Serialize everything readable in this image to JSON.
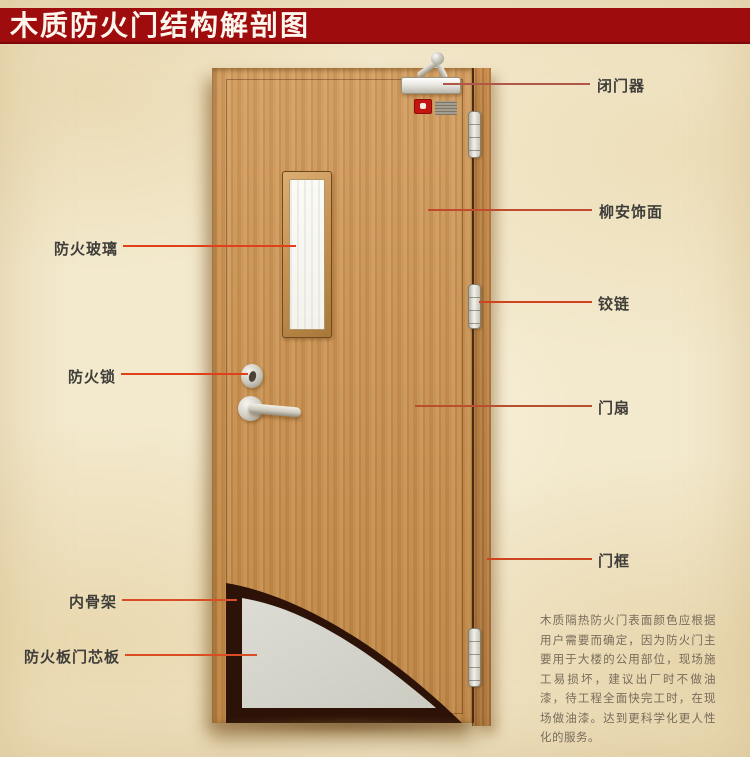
{
  "title": "木质防火门结构解剖图",
  "labels": {
    "door_closer": "闭门器",
    "veneer": "柳安饰面",
    "hinge": "铰链",
    "door_leaf": "门扇",
    "door_frame": "门框",
    "fire_glass": "防火玻璃",
    "fire_lock": "防火锁",
    "inner_skeleton": "内骨架",
    "core_board": "防火板门芯板"
  },
  "note": "木质隔热防火门表面颜色应根据用户需要而确定，因为防火门主要用于大楼的公用部位，现场施工易损坏，建议出厂时不做油漆，待工程全面快完工时，在现场做油漆。达到更科学化更人性化的服务。",
  "colors": {
    "banner_red": "#9e0c0e",
    "leader_line": "#d04320",
    "wood": "#c89153",
    "door_frame_wood": "#b57c41",
    "core_board_gray": "#d4d3cb",
    "inner_skeleton_dark": "#2c1207",
    "background_cream": "#f3e9cd"
  }
}
